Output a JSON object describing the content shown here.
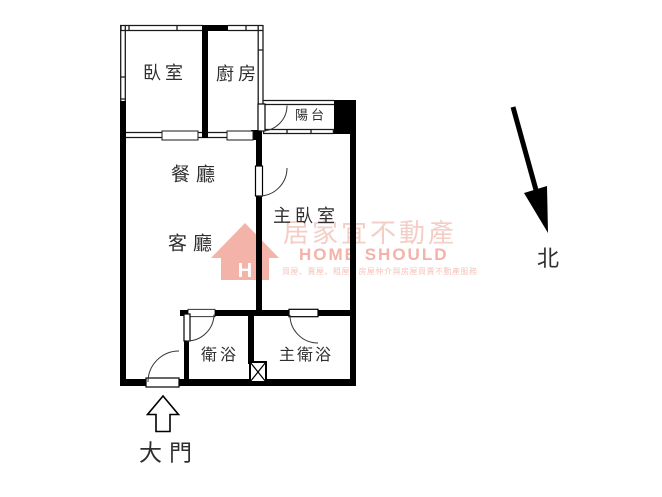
{
  "plan": {
    "title": "apartment floor plan",
    "rooms": {
      "bedroom": "臥室",
      "kitchen": "廚房",
      "balcony": "陽台",
      "dining": "餐廳",
      "living": "客廳",
      "master_bedroom": "主臥室",
      "bathroom": "衛浴",
      "master_bathroom": "主衛浴"
    },
    "annotations": {
      "entrance_label": "大門",
      "north_label": "北"
    }
  },
  "watermark": {
    "brand_zh": "居家宜不動產",
    "brand_en": "HOME SHOULD",
    "tagline": "買屋、賣屋、租屋、房屋仲介與房屋買賣不動產服務",
    "house_letter": "H",
    "color_zh": "#f4cdc6",
    "color_en": "#f5b2a8",
    "color_house": "#f3b3a9"
  },
  "colors": {
    "wall": "#000000",
    "label": "#2f2f2f",
    "background": "#ffffff"
  }
}
